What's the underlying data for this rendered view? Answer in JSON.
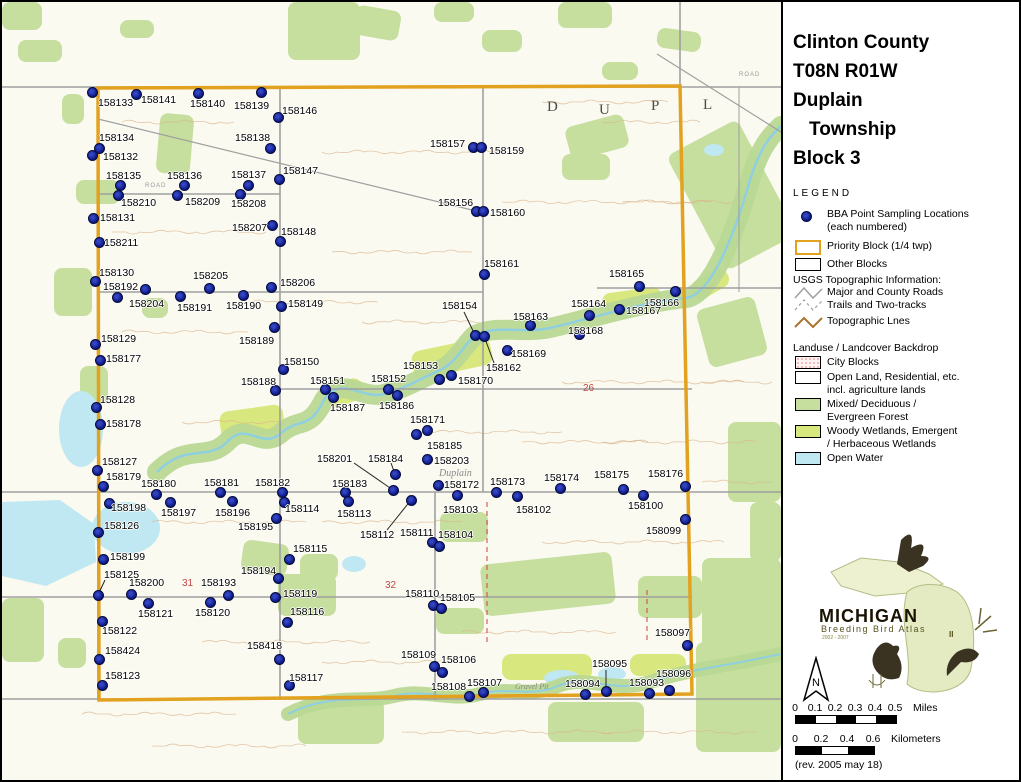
{
  "title": {
    "lines": [
      "Clinton County",
      "T08N R01W",
      "Duplain",
      "Township",
      "Block 3"
    ]
  },
  "legend": {
    "heading": "LEGEND",
    "bba_line1": "BBA Point Sampling Locations",
    "bba_line2": "(each numbered)",
    "priority": "Priority Block (1/4 twp)",
    "other": "Other Blocks",
    "usgs_heading": "USGS Topographic Information:",
    "roads_major": "Major and County Roads",
    "roads_trails": "Trails and Two-tracks",
    "topo": "Topographic Lnes"
  },
  "landuse": {
    "heading": "Landuse / Landcover Backdrop",
    "city": "City Blocks",
    "open1": "Open Land, Residential, etc.",
    "open2": "incl. agriculture lands",
    "forest1": "Mixed/ Deciduous /",
    "forest2": "Evergreen Forest",
    "wet1": "Woody Wetlands, Emergent",
    "wet2": "/ Herbaceous Wetlands",
    "water": "Open Water"
  },
  "logo": {
    "name": "MICHIGAN",
    "subtitle": "Breeding Bird Atlas",
    "years": "2002 - 2007",
    "numeral": "II"
  },
  "north": {
    "label": "N"
  },
  "scalebar": {
    "miles": {
      "ticks": [
        "0",
        "0.1",
        "0.2",
        "0.3",
        "0.4",
        "0.5"
      ],
      "unit": "Miles"
    },
    "km": {
      "ticks": [
        "0",
        "0.2",
        "0.4",
        "0.6"
      ],
      "unit": "Kilometers"
    },
    "rev": "(rev. 2005 may 18)"
  },
  "colors": {
    "accent": "#E2A11E",
    "dot": "#101D8E",
    "forest": "#C6DF9F",
    "wetland": "#D9E87E",
    "water": "#BFE8F2",
    "road": "#9F9F9F",
    "contour": "#D8B48E",
    "section": "#C04545"
  },
  "map": {
    "annotations": [
      {
        "text": "D",
        "x": 545,
        "y": 97,
        "cls": "twp-letter"
      },
      {
        "text": "U",
        "x": 597,
        "y": 100,
        "cls": "twp-letter"
      },
      {
        "text": "P",
        "x": 649,
        "y": 96,
        "cls": "twp-letter"
      },
      {
        "text": "L",
        "x": 701,
        "y": 95,
        "cls": "twp-letter"
      },
      {
        "text": "Duplain",
        "x": 437,
        "y": 466,
        "cls": "place"
      },
      {
        "text": "Gravel Pit",
        "x": 513,
        "y": 680,
        "cls": "place-sm"
      },
      {
        "text": "26",
        "x": 581,
        "y": 381,
        "cls": "section-num"
      },
      {
        "text": "31",
        "x": 180,
        "y": 576,
        "cls": "section-num"
      },
      {
        "text": "32",
        "x": 383,
        "y": 578,
        "cls": "section-num"
      },
      {
        "text": "ROAD",
        "x": 737,
        "y": 70,
        "cls": "road-sm"
      },
      {
        "text": "ROAD",
        "x": 143,
        "y": 181,
        "cls": "road-sm"
      }
    ],
    "points": [
      {
        "id": "158133",
        "x": 90,
        "y": 90,
        "lx": 96,
        "ly": 96
      },
      {
        "id": "158141",
        "x": 134,
        "y": 92,
        "lx": 139,
        "ly": 93
      },
      {
        "id": "158140",
        "x": 196,
        "y": 91,
        "lx": 188,
        "ly": 97
      },
      {
        "id": "158139",
        "x": 259,
        "y": 90,
        "lx": 232,
        "ly": 99
      },
      {
        "id": "158146",
        "x": 276,
        "y": 115,
        "lx": 280,
        "ly": 104
      },
      {
        "id": "158134",
        "x": 97,
        "y": 146,
        "lx": 97,
        "ly": 131
      },
      {
        "id": "158132",
        "x": 90,
        "y": 153,
        "lx": 101,
        "ly": 150
      },
      {
        "id": "158138",
        "x": 268,
        "y": 146,
        "lx": 233,
        "ly": 131
      },
      {
        "id": "158135",
        "x": 118,
        "y": 183,
        "lx": 104,
        "ly": 169
      },
      {
        "id": "158136",
        "x": 182,
        "y": 183,
        "lx": 165,
        "ly": 169
      },
      {
        "id": "158137",
        "x": 246,
        "y": 183,
        "lx": 229,
        "ly": 168
      },
      {
        "id": "158147",
        "x": 277,
        "y": 177,
        "lx": 281,
        "ly": 164
      },
      {
        "id": "158210",
        "x": 116,
        "y": 193,
        "lx": 119,
        "ly": 196
      },
      {
        "id": "158209",
        "x": 175,
        "y": 193,
        "lx": 183,
        "ly": 195
      },
      {
        "id": "158208",
        "x": 238,
        "y": 192,
        "lx": 229,
        "ly": 197
      },
      {
        "id": "158131",
        "x": 91,
        "y": 216,
        "lx": 98,
        "ly": 211
      },
      {
        "id": "158211",
        "x": 97,
        "y": 240,
        "lx": 102,
        "ly": 236
      },
      {
        "id": "158207",
        "x": 270,
        "y": 223,
        "lx": 230,
        "ly": 221
      },
      {
        "id": "158148",
        "x": 278,
        "y": 239,
        "lx": 279,
        "ly": 225
      },
      {
        "id": "158157",
        "x": 471,
        "y": 145,
        "lx": 428,
        "ly": 137
      },
      {
        "id": "158159",
        "x": 479,
        "y": 145,
        "lx": 487,
        "ly": 144
      },
      {
        "id": "158156",
        "x": 474,
        "y": 209,
        "lx": 436,
        "ly": 196
      },
      {
        "id": "158160",
        "x": 481,
        "y": 209,
        "lx": 488,
        "ly": 206
      },
      {
        "id": "158161",
        "x": 482,
        "y": 272,
        "lx": 482,
        "ly": 257
      },
      {
        "id": "158165",
        "x": 637,
        "y": 284,
        "lx": 607,
        "ly": 267
      },
      {
        "id": "158166",
        "x": 673,
        "y": 289,
        "lx": 642,
        "ly": 296
      },
      {
        "id": "158167",
        "x": 617,
        "y": 307,
        "lx": 624,
        "ly": 304
      },
      {
        "id": "158164",
        "x": 587,
        "y": 313,
        "lx": 569,
        "ly": 297
      },
      {
        "id": "158163",
        "x": 528,
        "y": 323,
        "lx": 511,
        "ly": 310
      },
      {
        "id": "158168",
        "x": 577,
        "y": 332,
        "lx": 566,
        "ly": 324
      },
      {
        "id": "158154",
        "x": 473,
        "y": 333,
        "lx": 440,
        "ly": 299,
        "leader": [
          462,
          310
        ]
      },
      {
        "id": "158162",
        "x": 482,
        "y": 334,
        "lx": 484,
        "ly": 361,
        "leader": [
          492,
          361
        ]
      },
      {
        "id": "158169",
        "x": 505,
        "y": 348,
        "lx": 509,
        "ly": 347
      },
      {
        "id": "158130",
        "x": 93,
        "y": 279,
        "lx": 97,
        "ly": 266
      },
      {
        "id": "158192",
        "x": 115,
        "y": 295,
        "lx": 101,
        "ly": 280
      },
      {
        "id": "158204",
        "x": 143,
        "y": 287,
        "lx": 127,
        "ly": 297
      },
      {
        "id": "158205",
        "x": 207,
        "y": 286,
        "lx": 191,
        "ly": 269
      },
      {
        "id": "158191",
        "x": 178,
        "y": 294,
        "lx": 175,
        "ly": 301
      },
      {
        "id": "158190",
        "x": 241,
        "y": 293,
        "lx": 224,
        "ly": 299
      },
      {
        "id": "158206",
        "x": 269,
        "y": 285,
        "lx": 278,
        "ly": 276
      },
      {
        "id": "158149",
        "x": 279,
        "y": 304,
        "lx": 286,
        "ly": 297
      },
      {
        "id": "158189",
        "x": 272,
        "y": 325,
        "lx": 237,
        "ly": 334
      },
      {
        "id": "158129",
        "x": 93,
        "y": 342,
        "lx": 99,
        "ly": 332
      },
      {
        "id": "158177",
        "x": 98,
        "y": 358,
        "lx": 104,
        "ly": 352
      },
      {
        "id": "158150",
        "x": 281,
        "y": 367,
        "lx": 282,
        "ly": 355
      },
      {
        "id": "158128",
        "x": 94,
        "y": 405,
        "lx": 98,
        "ly": 393
      },
      {
        "id": "158178",
        "x": 98,
        "y": 422,
        "lx": 104,
        "ly": 417
      },
      {
        "id": "158188",
        "x": 273,
        "y": 388,
        "lx": 239,
        "ly": 375
      },
      {
        "id": "158151",
        "x": 323,
        "y": 387,
        "lx": 308,
        "ly": 374
      },
      {
        "id": "158187",
        "x": 331,
        "y": 395,
        "lx": 328,
        "ly": 401
      },
      {
        "id": "158152",
        "x": 386,
        "y": 387,
        "lx": 369,
        "ly": 372
      },
      {
        "id": "158186",
        "x": 395,
        "y": 393,
        "lx": 377,
        "ly": 399
      },
      {
        "id": "158153",
        "x": 437,
        "y": 377,
        "lx": 401,
        "ly": 359
      },
      {
        "id": "158170",
        "x": 449,
        "y": 373,
        "lx": 456,
        "ly": 374
      },
      {
        "id": "158171",
        "x": 425,
        "y": 428,
        "lx": 408,
        "ly": 413
      },
      {
        "id": "158185",
        "x": 414,
        "y": 432,
        "lx": 425,
        "ly": 439
      },
      {
        "id": "158203",
        "x": 425,
        "y": 457,
        "lx": 432,
        "ly": 454
      },
      {
        "id": "158184",
        "x": 393,
        "y": 472,
        "lx": 366,
        "ly": 452,
        "leader": [
          389,
          461
        ]
      },
      {
        "id": "158201",
        "x": 391,
        "y": 488,
        "lx": 315,
        "ly": 452,
        "leader": [
          352,
          461
        ]
      },
      {
        "id": "158183",
        "x": 343,
        "y": 490,
        "lx": 330,
        "ly": 477
      },
      {
        "id": "158113",
        "x": 346,
        "y": 499,
        "lx": 335,
        "ly": 507
      },
      {
        "id": "158112",
        "x": 409,
        "y": 498,
        "lx": 358,
        "ly": 528,
        "leader": [
          385,
          528
        ]
      },
      {
        "id": "158172",
        "x": 436,
        "y": 483,
        "lx": 442,
        "ly": 478
      },
      {
        "id": "158103",
        "x": 455,
        "y": 493,
        "lx": 441,
        "ly": 503
      },
      {
        "id": "158173",
        "x": 494,
        "y": 490,
        "lx": 488,
        "ly": 475
      },
      {
        "id": "158102",
        "x": 515,
        "y": 494,
        "lx": 514,
        "ly": 503
      },
      {
        "id": "158174",
        "x": 558,
        "y": 486,
        "lx": 542,
        "ly": 471
      },
      {
        "id": "158175",
        "x": 621,
        "y": 487,
        "lx": 592,
        "ly": 468
      },
      {
        "id": "158176",
        "x": 683,
        "y": 484,
        "lx": 646,
        "ly": 467
      },
      {
        "id": "158100",
        "x": 641,
        "y": 493,
        "lx": 626,
        "ly": 499
      },
      {
        "id": "158099",
        "x": 683,
        "y": 517,
        "lx": 644,
        "ly": 524
      },
      {
        "id": "158111",
        "x": 430,
        "y": 540,
        "lx": 398,
        "ly": 526
      },
      {
        "id": "158104",
        "x": 437,
        "y": 544,
        "lx": 436,
        "ly": 528
      },
      {
        "id": "158127",
        "x": 95,
        "y": 468,
        "lx": 100,
        "ly": 455
      },
      {
        "id": "158179",
        "x": 101,
        "y": 484,
        "lx": 104,
        "ly": 470
      },
      {
        "id": "158180",
        "x": 154,
        "y": 492,
        "lx": 139,
        "ly": 477
      },
      {
        "id": "158181",
        "x": 218,
        "y": 490,
        "lx": 202,
        "ly": 476
      },
      {
        "id": "158182",
        "x": 280,
        "y": 490,
        "lx": 253,
        "ly": 476
      },
      {
        "id": "158114",
        "x": 282,
        "y": 500,
        "lx": 283,
        "ly": 502
      },
      {
        "id": "158198",
        "x": 107,
        "y": 501,
        "lx": 109,
        "ly": 501
      },
      {
        "id": "158197",
        "x": 168,
        "y": 500,
        "lx": 159,
        "ly": 506
      },
      {
        "id": "158196",
        "x": 230,
        "y": 499,
        "lx": 213,
        "ly": 506
      },
      {
        "id": "158195",
        "x": 274,
        "y": 516,
        "lx": 236,
        "ly": 520
      },
      {
        "id": "158126",
        "x": 96,
        "y": 530,
        "lx": 102,
        "ly": 519
      },
      {
        "id": "158199",
        "x": 101,
        "y": 557,
        "lx": 108,
        "ly": 550
      },
      {
        "id": "158115",
        "x": 287,
        "y": 557,
        "lx": 291,
        "ly": 542
      },
      {
        "id": "158125",
        "x": 96,
        "y": 593,
        "lx": 102,
        "ly": 568,
        "leader": [
          103,
          578
        ]
      },
      {
        "id": "158200",
        "x": 129,
        "y": 592,
        "lx": 127,
        "ly": 576
      },
      {
        "id": "158193",
        "x": 226,
        "y": 593,
        "lx": 199,
        "ly": 576
      },
      {
        "id": "158194",
        "x": 276,
        "y": 576,
        "lx": 239,
        "ly": 564
      },
      {
        "id": "158119",
        "x": 273,
        "y": 595,
        "lx": 281,
        "ly": 587
      },
      {
        "id": "158121",
        "x": 146,
        "y": 601,
        "lx": 136,
        "ly": 607
      },
      {
        "id": "158120",
        "x": 208,
        "y": 600,
        "lx": 193,
        "ly": 606
      },
      {
        "id": "158116",
        "x": 285,
        "y": 620,
        "lx": 288,
        "ly": 605
      },
      {
        "id": "158122",
        "x": 100,
        "y": 619,
        "lx": 100,
        "ly": 624
      },
      {
        "id": "158424",
        "x": 97,
        "y": 657,
        "lx": 103,
        "ly": 644
      },
      {
        "id": "158123",
        "x": 100,
        "y": 683,
        "lx": 103,
        "ly": 669
      },
      {
        "id": "158418",
        "x": 277,
        "y": 657,
        "lx": 245,
        "ly": 639
      },
      {
        "id": "158117",
        "x": 287,
        "y": 683,
        "lx": 287,
        "ly": 671
      },
      {
        "id": "158110",
        "x": 431,
        "y": 603,
        "lx": 403,
        "ly": 587
      },
      {
        "id": "158105",
        "x": 439,
        "y": 606,
        "lx": 438,
        "ly": 591
      },
      {
        "id": "158109",
        "x": 432,
        "y": 664,
        "lx": 399,
        "ly": 648
      },
      {
        "id": "158106",
        "x": 440,
        "y": 670,
        "lx": 439,
        "ly": 653
      },
      {
        "id": "158108",
        "x": 467,
        "y": 694,
        "lx": 429,
        "ly": 680
      },
      {
        "id": "158107",
        "x": 481,
        "y": 690,
        "lx": 465,
        "ly": 676
      },
      {
        "id": "158094",
        "x": 583,
        "y": 692,
        "lx": 563,
        "ly": 677
      },
      {
        "id": "158095",
        "x": 604,
        "y": 689,
        "lx": 590,
        "ly": 657,
        "leader": [
          604,
          668
        ]
      },
      {
        "id": "158093",
        "x": 647,
        "y": 691,
        "lx": 627,
        "ly": 676
      },
      {
        "id": "158096",
        "x": 667,
        "y": 688,
        "lx": 654,
        "ly": 667
      },
      {
        "id": "158097",
        "x": 685,
        "y": 643,
        "lx": 653,
        "ly": 626
      }
    ]
  }
}
